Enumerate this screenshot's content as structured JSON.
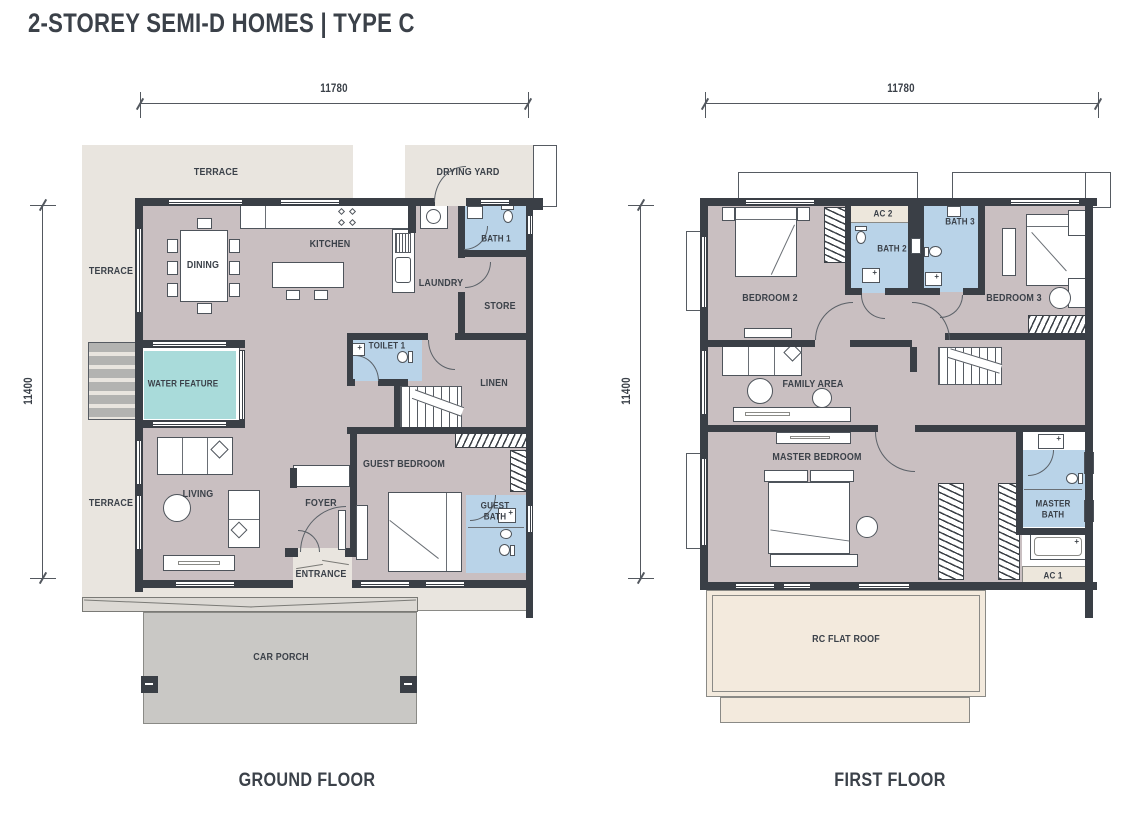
{
  "title": "2-STOREY SEMI-D HOMES | TYPE C",
  "colors": {
    "wall": "#3a3f46",
    "interior": "#c9bfc1",
    "outdoor": "#e9e5df",
    "bath": "#b9d3e8",
    "water": "#a9dbda",
    "porch": "#c9c8c5",
    "roof": "#f3eadd",
    "ac": "#ede7dc",
    "text": "#3b4149"
  },
  "dimensions": {
    "width": "11780",
    "height": "11400"
  },
  "ground_floor": {
    "caption": "GROUND FLOOR",
    "labels": {
      "terrace": "TERRACE",
      "drying_yard": "DRYING YARD",
      "kitchen": "KITCHEN",
      "dining": "DINING",
      "bath1": "BATH 1",
      "laundry": "LAUNDRY",
      "store": "STORE",
      "toilet1": "TOILET 1",
      "linen": "LINEN",
      "water_feature": "WATER FEATURE",
      "living": "LIVING",
      "foyer": "FOYER",
      "guest_bedroom": "GUEST BEDROOM",
      "guest_bath": "GUEST BATH",
      "entrance": "ENTRANCE",
      "car_porch": "CAR PORCH"
    }
  },
  "first_floor": {
    "caption": "FIRST FLOOR",
    "labels": {
      "bedroom2": "BEDROOM 2",
      "ac2": "AC 2",
      "bath2": "BATH 2",
      "bath3": "BATH 3",
      "bedroom3": "BEDROOM 3",
      "family_area": "FAMILY AREA",
      "master_bedroom": "MASTER BEDROOM",
      "master_bath": "MASTER BATH",
      "ac1": "AC 1",
      "rc_flat_roof": "RC FLAT ROOF"
    }
  }
}
